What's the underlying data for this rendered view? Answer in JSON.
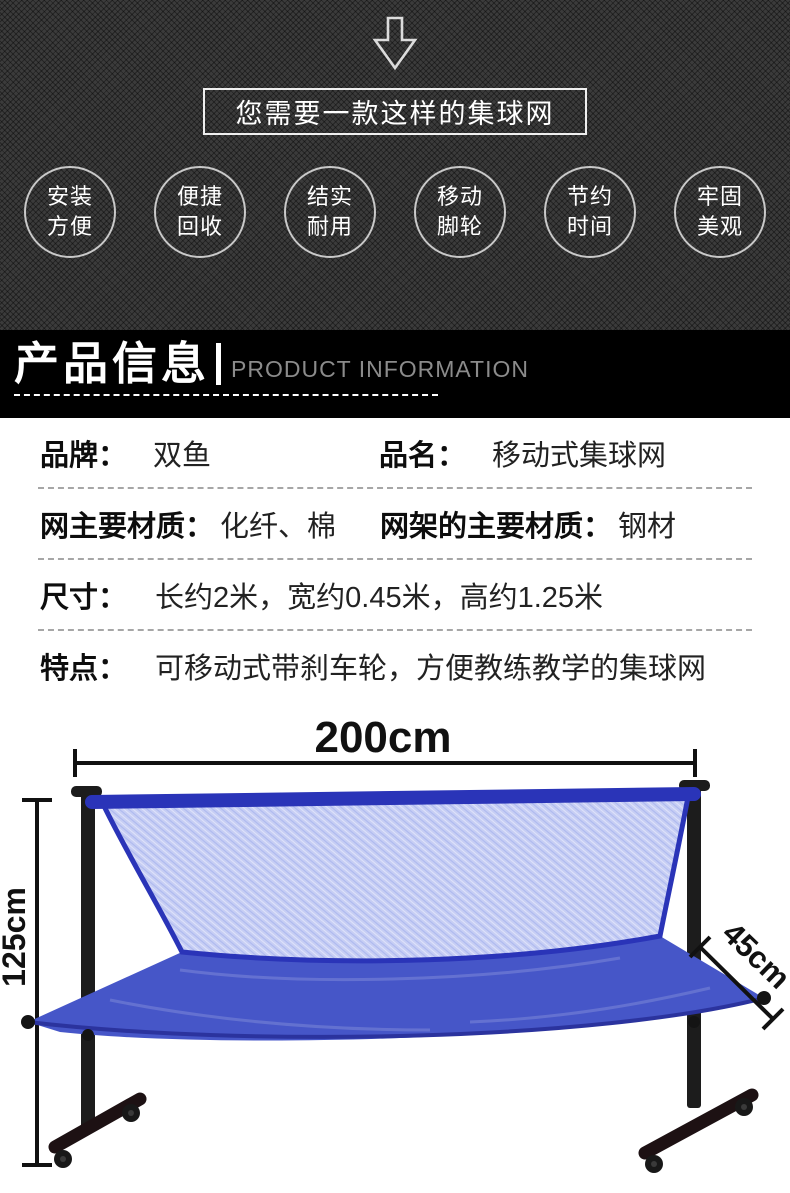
{
  "hero": {
    "arrow_icon": "down-arrow",
    "callout": "您需要一款这样的集球网",
    "features": [
      {
        "line1": "安装",
        "line2": "方便"
      },
      {
        "line1": "便捷",
        "line2": "回收"
      },
      {
        "line1": "结实",
        "line2": "耐用"
      },
      {
        "line1": "移动",
        "line2": "脚轮"
      },
      {
        "line1": "节约",
        "line2": "时间"
      },
      {
        "line1": "牢固",
        "line2": "美观"
      }
    ]
  },
  "banner": {
    "title_cn": "产品信息",
    "title_en": "PRODUCT INFORMATION"
  },
  "specs": {
    "row1": {
      "label1": "品牌：",
      "value1": "双鱼",
      "label2": "品名：",
      "value2": "移动式集球网"
    },
    "row2": {
      "label1": "网主要材质：",
      "value1": "化纤、棉",
      "label2": "网架的主要材质：",
      "value2": "钢材"
    },
    "row3": {
      "label": "尺寸：",
      "value": "长约2米，宽约0.45米，高约1.25米"
    },
    "row4": {
      "label": "特点：",
      "value": "可移动式带刹车轮，方便教练教学的集球网"
    }
  },
  "diagram": {
    "width_label": "200cm",
    "height_label": "125cm",
    "depth_label": "45cm"
  },
  "colors": {
    "hero_bg": "#3b3b3b",
    "banner_bg": "#000000",
    "net_mesh": "#c7cef4",
    "net_border": "#2a34b8",
    "tray": "#4656c8",
    "frame": "#1c1c1c",
    "dimension_text": "#111111"
  }
}
